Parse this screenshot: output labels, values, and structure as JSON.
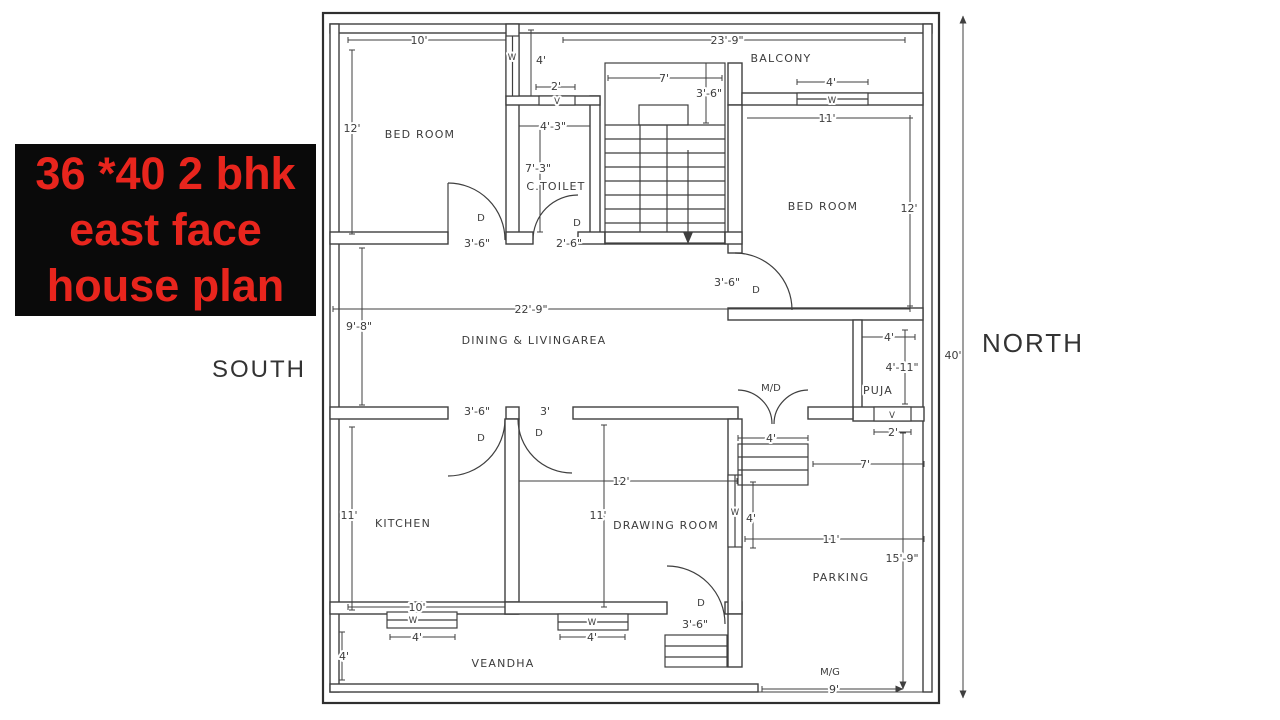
{
  "title_card": {
    "lines": [
      "36 *40 2 bhk",
      "east face",
      "house plan"
    ],
    "bg_color": "#0a0a0a",
    "text_color": "#e8251d"
  },
  "compass": {
    "south": "SOUTH",
    "north": "NORTH"
  },
  "colors": {
    "line": "#3f3f3f",
    "background": "#ffffff"
  },
  "plan": {
    "overall_width_label": "23'-9\"",
    "overall_height_label": "40'",
    "annotations": [
      {
        "name": "room-label-bedroom-1",
        "text": "BED ROOM",
        "x": 420,
        "y": 138,
        "cls": "room"
      },
      {
        "name": "room-label-ctoilet",
        "text": "C.TOILET",
        "x": 556,
        "y": 190,
        "cls": "room"
      },
      {
        "name": "room-label-balcony",
        "text": "BALCONY",
        "x": 781,
        "y": 62,
        "cls": "room"
      },
      {
        "name": "room-label-bedroom-2",
        "text": "BED ROOM",
        "x": 823,
        "y": 210,
        "cls": "room"
      },
      {
        "name": "room-label-dining-living",
        "text": "DINING & LIVINGAREA",
        "x": 534,
        "y": 344,
        "cls": "room"
      },
      {
        "name": "room-label-puja",
        "text": "PUJA",
        "x": 878,
        "y": 394,
        "cls": "room"
      },
      {
        "name": "room-label-kitchen",
        "text": "KITCHEN",
        "x": 403,
        "y": 527,
        "cls": "room"
      },
      {
        "name": "room-label-drawing-room",
        "text": "DRAWING ROOM",
        "x": 666,
        "y": 529,
        "cls": "room"
      },
      {
        "name": "room-label-parking",
        "text": "PARKING",
        "x": 841,
        "y": 581,
        "cls": "room"
      },
      {
        "name": "room-label-verandah",
        "text": "VEANDHA",
        "x": 503,
        "y": 667,
        "cls": "room"
      },
      {
        "name": "dim-bedroom1-width",
        "text": "10'",
        "x": 419,
        "y": 44,
        "cls": "dim"
      },
      {
        "name": "dim-overall-top",
        "text": "23'-9\"",
        "x": 727,
        "y": 44,
        "cls": "dim"
      },
      {
        "name": "dim-passage-height",
        "text": "4'",
        "x": 541,
        "y": 64,
        "cls": "dim"
      },
      {
        "name": "dim-vent1-width",
        "text": "2'",
        "x": 556,
        "y": 90,
        "cls": "dim"
      },
      {
        "name": "dim-toilet-width",
        "text": "4'-3\"",
        "x": 553,
        "y": 130,
        "cls": "dim"
      },
      {
        "name": "dim-toilet-height",
        "text": "7'-3\"",
        "x": 538,
        "y": 172,
        "cls": "dim"
      },
      {
        "name": "dim-stairs-width",
        "text": "7'",
        "x": 664,
        "y": 82,
        "cls": "dim"
      },
      {
        "name": "dim-stairs-landing",
        "text": "3'-6\"",
        "x": 709,
        "y": 97,
        "cls": "dim"
      },
      {
        "name": "dim-balcony-window",
        "text": "4'",
        "x": 831,
        "y": 86,
        "cls": "dim"
      },
      {
        "name": "dim-bedroom2-width",
        "text": "11'",
        "x": 827,
        "y": 122,
        "cls": "dim"
      },
      {
        "name": "dim-bedroom1-height",
        "text": "12'",
        "x": 352,
        "y": 132,
        "cls": "dim"
      },
      {
        "name": "dim-bedroom2-height",
        "text": "12'",
        "x": 909,
        "y": 212,
        "cls": "dim"
      },
      {
        "name": "dim-bedroom1-door",
        "text": "3'-6\"",
        "x": 477,
        "y": 247,
        "cls": "dim"
      },
      {
        "name": "dim-toilet-door",
        "text": "2'-6\"",
        "x": 569,
        "y": 247,
        "cls": "dim"
      },
      {
        "name": "dim-bedroom2-door",
        "text": "3'-6\"",
        "x": 727,
        "y": 286,
        "cls": "dim"
      },
      {
        "name": "dim-dining-width",
        "text": "22'-9\"",
        "x": 531,
        "y": 313,
        "cls": "dim"
      },
      {
        "name": "dim-dining-height",
        "text": "9'-8\"",
        "x": 359,
        "y": 330,
        "cls": "dim"
      },
      {
        "name": "dim-puja-width",
        "text": "4'",
        "x": 889,
        "y": 341,
        "cls": "dim"
      },
      {
        "name": "dim-puja-height",
        "text": "4'-11\"",
        "x": 902,
        "y": 371,
        "cls": "dim"
      },
      {
        "name": "dim-vent2-width",
        "text": "2'",
        "x": 893,
        "y": 436,
        "cls": "dim"
      },
      {
        "name": "dim-main-door",
        "text": "4'",
        "x": 771,
        "y": 442,
        "cls": "dim"
      },
      {
        "name": "dim-parking-top",
        "text": "7'",
        "x": 865,
        "y": 468,
        "cls": "dim"
      },
      {
        "name": "dim-parking-width",
        "text": "11'",
        "x": 831,
        "y": 543,
        "cls": "dim"
      },
      {
        "name": "dim-parking-height",
        "text": "15'-9\"",
        "x": 902,
        "y": 562,
        "cls": "dim"
      },
      {
        "name": "dim-kitchen-door",
        "text": "3'-6\"",
        "x": 477,
        "y": 415,
        "cls": "dim"
      },
      {
        "name": "dim-drawing-door",
        "text": "3'",
        "x": 545,
        "y": 415,
        "cls": "dim"
      },
      {
        "name": "dim-drawing-width",
        "text": "12'",
        "x": 621,
        "y": 485,
        "cls": "dim"
      },
      {
        "name": "dim-drawing-height",
        "text": "11'",
        "x": 598,
        "y": 519,
        "cls": "dim"
      },
      {
        "name": "dim-kitchen-height",
        "text": "11'",
        "x": 349,
        "y": 519,
        "cls": "dim"
      },
      {
        "name": "dim-drawing-window",
        "text": "4'",
        "x": 751,
        "y": 522,
        "cls": "dim"
      },
      {
        "name": "dim-kitchen-width",
        "text": "10'",
        "x": 417,
        "y": 611,
        "cls": "dim"
      },
      {
        "name": "dim-kitchen-veranda-window",
        "text": "4'",
        "x": 417,
        "y": 641,
        "cls": "dim"
      },
      {
        "name": "dim-drawing-veranda-window",
        "text": "4'",
        "x": 592,
        "y": 641,
        "cls": "dim"
      },
      {
        "name": "dim-verandah-height",
        "text": "4'",
        "x": 344,
        "y": 660,
        "cls": "dim"
      },
      {
        "name": "dim-drawing-exit-door",
        "text": "3'-6\"",
        "x": 695,
        "y": 628,
        "cls": "dim"
      },
      {
        "name": "dim-main-gate",
        "text": "9'",
        "x": 834,
        "y": 693,
        "cls": "dim"
      },
      {
        "name": "dim-overall-height",
        "text": "40'",
        "x": 953,
        "y": 359,
        "cls": "dim"
      },
      {
        "name": "door-label-bedroom1",
        "text": "D",
        "x": 481,
        "y": 221,
        "cls": "small"
      },
      {
        "name": "door-label-toilet",
        "text": "D",
        "x": 577,
        "y": 226,
        "cls": "small"
      },
      {
        "name": "door-label-bedroom2",
        "text": "D",
        "x": 756,
        "y": 293,
        "cls": "small"
      },
      {
        "name": "door-label-kitchen",
        "text": "D",
        "x": 481,
        "y": 441,
        "cls": "small"
      },
      {
        "name": "door-label-drawing",
        "text": "D",
        "x": 539,
        "y": 436,
        "cls": "small"
      },
      {
        "name": "door-label-drawing-exit",
        "text": "D",
        "x": 701,
        "y": 606,
        "cls": "small"
      },
      {
        "name": "main-door-label",
        "text": "M/D",
        "x": 771,
        "y": 391,
        "cls": "small"
      },
      {
        "name": "main-gate-label",
        "text": "M/G",
        "x": 830,
        "y": 675,
        "cls": "small"
      },
      {
        "name": "window-label-passage",
        "text": "W",
        "x": 512,
        "y": 60,
        "cls": "tiny"
      },
      {
        "name": "window-label-balcony",
        "text": "W",
        "x": 832,
        "y": 103,
        "cls": "tiny"
      },
      {
        "name": "window-label-drawing",
        "text": "W",
        "x": 735,
        "y": 515,
        "cls": "tiny"
      },
      {
        "name": "window-label-kitchen",
        "text": "W",
        "x": 413,
        "y": 623,
        "cls": "tiny"
      },
      {
        "name": "window-label-drawing2",
        "text": "W",
        "x": 592,
        "y": 625,
        "cls": "tiny"
      },
      {
        "name": "vent-label-toilet",
        "text": "V",
        "x": 557,
        "y": 104,
        "cls": "tiny"
      },
      {
        "name": "vent-label-puja",
        "text": "V",
        "x": 892,
        "y": 418,
        "cls": "tiny"
      }
    ]
  }
}
